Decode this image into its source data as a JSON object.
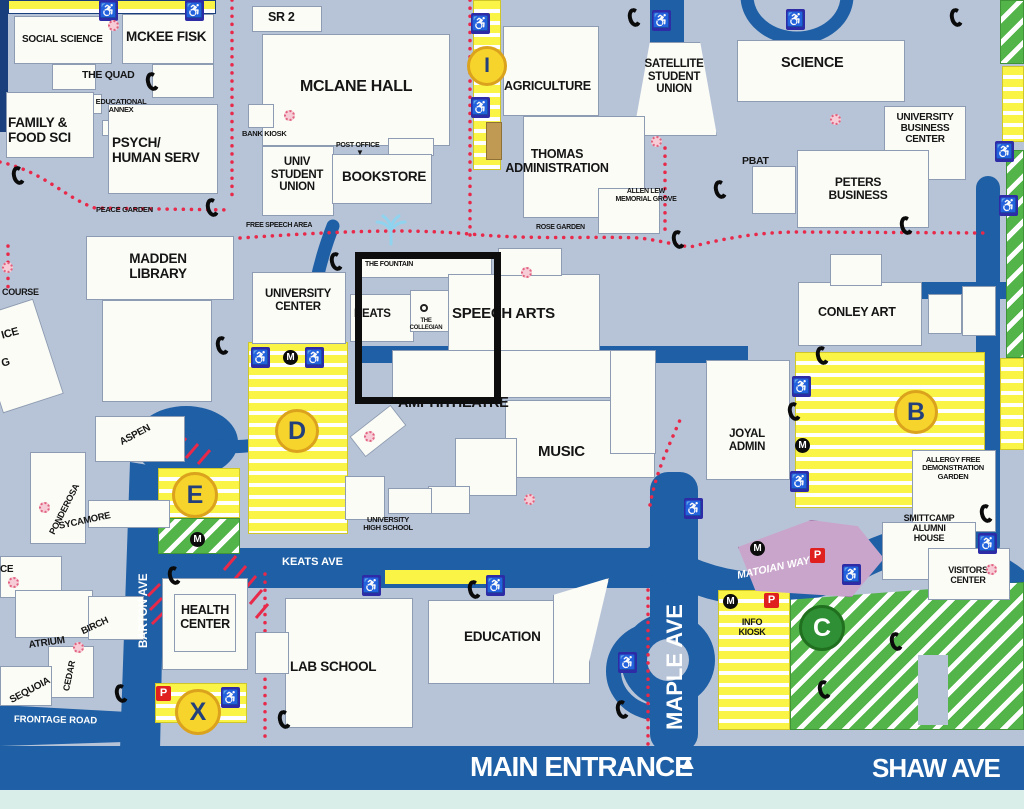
{
  "labels": {
    "social_science": "SOCIAL SCIENCE",
    "mckee_fisk": "MCKEE FISK",
    "the_quad": "THE QUAD",
    "educational_annex": "EDUCATIONAL\nANNEX",
    "family_food_sci": "FAMILY &\nFOOD SCI",
    "psych_human_serv": "PSYCH/\nHUMAN SERV",
    "peace_garden": "PEACE GARDEN",
    "sr2": "SR 2",
    "mclane_hall": "MCLANE HALL",
    "bank_kiosk": "BANK KIOSK",
    "univ_student_union": "UNIV\nSTUDENT\nUNION",
    "post_office": "POST OFFICE",
    "post_office_marker": "▼",
    "bookstore": "BOOKSTORE",
    "free_speech_area": "FREE SPEECH AREA",
    "agriculture": "AGRICULTURE",
    "satellite_student_union": "SATELLITE\nSTUDENT\nUNION",
    "thomas_administration": "THOMAS\nADMINISTRATION",
    "allen_lew": "ALLEN LEW\nMEMORIAL GROVE",
    "rose_garden": "ROSE GARDEN",
    "science": "SCIENCE",
    "university_business_center": "UNIVERSITY\nBUSINESS\nCENTER",
    "pbat": "PBAT",
    "peters_business": "PETERS\nBUSINESS",
    "madden_library": "MADDEN\nLIBRARY",
    "university_center": "UNIVERSITY\nCENTER",
    "the_fountain": "THE FOUNTAIN",
    "keats": "KEATS",
    "the_collegian": "THE\nCOLLEGIAN",
    "speech_arts": "SPEECH ARTS",
    "amphitheatre": "AMPHITHEATRE",
    "music": "MUSIC",
    "university_high_school": "UNIVERSITY\nHIGH SCHOOL",
    "joyal_admin": "JOYAL\nADMIN",
    "conley_art": "CONLEY ART",
    "allergy_garden": "ALLERGY FREE\nDEMONSTRATION\nGARDEN",
    "smittcamp": "SMITTCAMP\nALUMNI\nHOUSE",
    "visitors_center": "VISITORS\nCENTER",
    "health_center": "HEALTH\nCENTER",
    "lab_school": "LAB SCHOOL",
    "education": "EDUCATION",
    "info_kiosk": "INFO\nKIOSK",
    "aspen": "ASPEN",
    "ponderosa": "PONDEROSA",
    "sycamore": "SYCAMORE",
    "atrium": "ATRIUM",
    "birch": "BIRCH",
    "cedar": "CEDAR",
    "sequoia": "SEQUOIA",
    "course_fragment": "COURSE",
    "ice_fragment": "ICE",
    "g_fragment": "G",
    "ce_fragment": "CE"
  },
  "roads": {
    "keats_ave": "KEATS AVE",
    "barton_ave": "BARTON AVE",
    "maple_ave": "MAPLE AVE",
    "matoian_way": "MATOIAN WAY",
    "frontage_road": "FRONTAGE ROAD",
    "main_entrance": "MAIN ENTRANCE",
    "shaw_ave": "SHAW AVE",
    "north_arrow": "▲"
  },
  "parking": {
    "lot_d": "D",
    "lot_e": "E",
    "lot_b": "B",
    "lot_c": "C",
    "lot_x": "X",
    "info_point": "I",
    "meter_badge": "M",
    "pay_badge": "P"
  },
  "icons": {
    "wheelchair": "♿"
  },
  "colors": {
    "background": "#b7c4d8",
    "road_blue": "#1e5fa5",
    "building_white": "#fcfcf7",
    "lot_yellow": "#f9f446",
    "lot_green": "#53b44a",
    "dotted_path_red": "#e8294a",
    "structure_pink": "#caa5cb",
    "annotation_black": "#0d0d0d",
    "mint_strip": "#d9ede9",
    "marker_yellow": "#f7d42c"
  }
}
